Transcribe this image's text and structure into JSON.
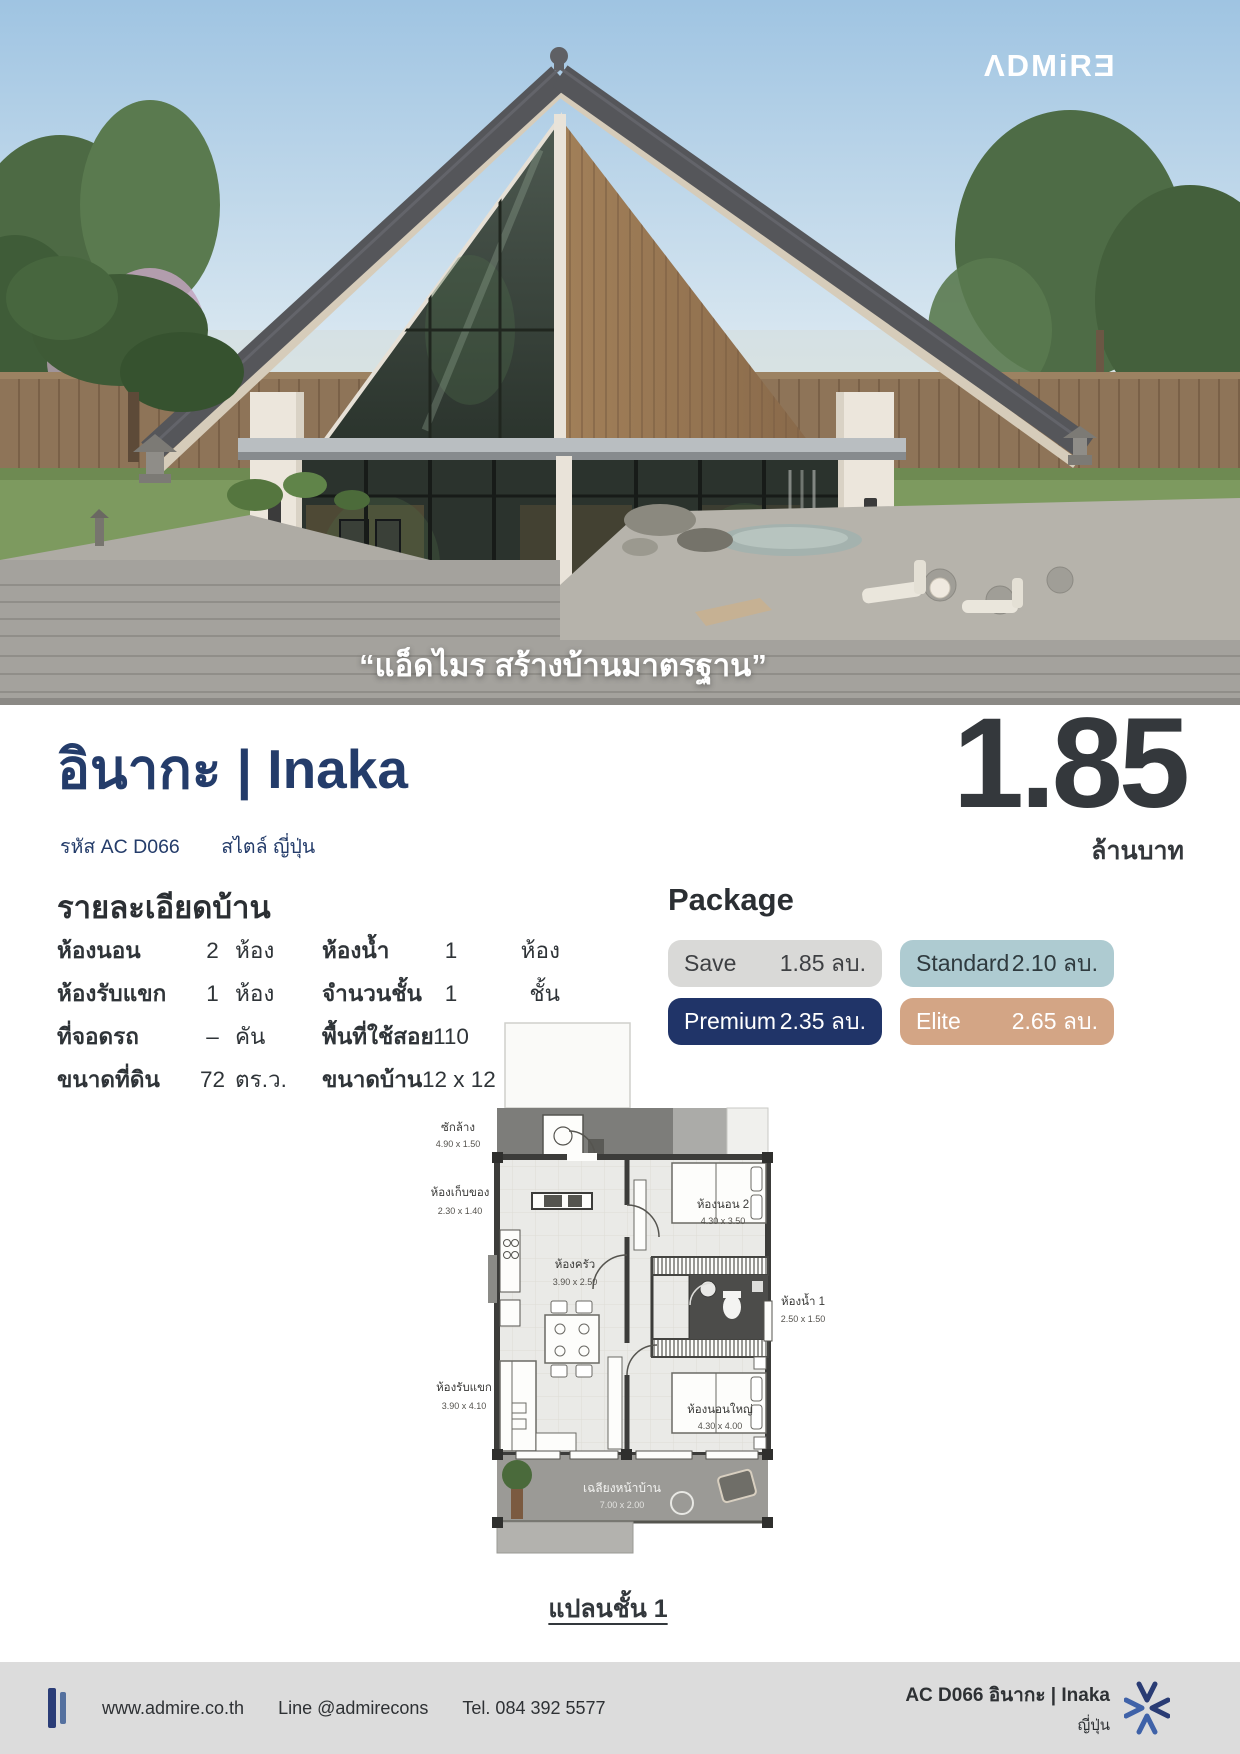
{
  "colors": {
    "navy": "#243c6a",
    "charcoal": "#34383c",
    "ink": "#2f3438",
    "footer_bg": "#dcdcdc"
  },
  "brand": {
    "logo": "ΛDMiRƎ",
    "tagline": "“แอ็ดไมร สร้างบ้านมาตรฐาน”"
  },
  "header": {
    "title": "อินากะ | Inaka",
    "code": "รหัส AC D066",
    "style": "สไตล์ ญี่ปุ่น",
    "price": "1.85",
    "price_unit": "ล้านบาท"
  },
  "details": {
    "heading": "รายละเอียดบ้าน",
    "rows": [
      {
        "l1": "ห้องนอน",
        "v1": "2",
        "u1": "ห้อง",
        "l2": "ห้องน้ำ",
        "v2": "1",
        "u2": "ห้อง"
      },
      {
        "l1": "ห้องรับแขก",
        "v1": "1",
        "u1": "ห้อง",
        "l2": "จำนวนชั้น",
        "v2": "1",
        "u2": "ชั้น"
      },
      {
        "l1": "ที่จอดรถ",
        "v1": "–",
        "u1": "คัน",
        "l2": "พื้นที่ใช้สอย",
        "v2": "110",
        "u2": "ตร.ม."
      },
      {
        "l1": "ขนาดที่ดิน",
        "v1": "72",
        "u1": "ตร.ว.",
        "l2": "ขนาดบ้าน",
        "v2": "12 x 12",
        "u2": "ม."
      }
    ]
  },
  "package": {
    "heading": "Package",
    "tiles": [
      {
        "label": "Save",
        "value": "1.85 ลบ.",
        "bg": "#d9d9d7",
        "fg": "#3e4043"
      },
      {
        "label": "Standard",
        "value": "2.10 ลบ.",
        "bg": "#aecbd1",
        "fg": "#2f3a3e"
      },
      {
        "label": "Premium",
        "value": "2.35 ลบ.",
        "bg": "#203468",
        "fg": "#ffffff"
      },
      {
        "label": "Elite",
        "value": "2.65 ลบ.",
        "bg": "#d3a585",
        "fg": "#ffffff"
      }
    ]
  },
  "floorplan": {
    "caption": "แปลนชั้น 1",
    "rooms": [
      {
        "name": "ซักล้าง",
        "dims": "4.90 x 1.50"
      },
      {
        "name": "ห้องเก็บของ",
        "dims": "2.30 x 1.40"
      },
      {
        "name": "ห้องนอน 2",
        "dims": "4.30 x 3.50"
      },
      {
        "name": "ห้องครัว",
        "dims": "3.90 x 2.50"
      },
      {
        "name": "ห้องน้ำ 1",
        "dims": "2.50 x 1.50"
      },
      {
        "name": "ห้องรับแขก",
        "dims": "3.90 x 4.10"
      },
      {
        "name": "ห้องนอนใหญ่",
        "dims": "4.30 x 4.00"
      },
      {
        "name": "เฉลียงหน้าบ้าน",
        "dims": "7.00 x 2.00"
      }
    ]
  },
  "footer": {
    "website": "www.admire.co.th",
    "line": "Line @admirecons",
    "tel": "Tel. 084 392 5577",
    "model_code": "AC D066 อินากะ | Inaka",
    "model_style": "ญี่ปุ่น"
  }
}
